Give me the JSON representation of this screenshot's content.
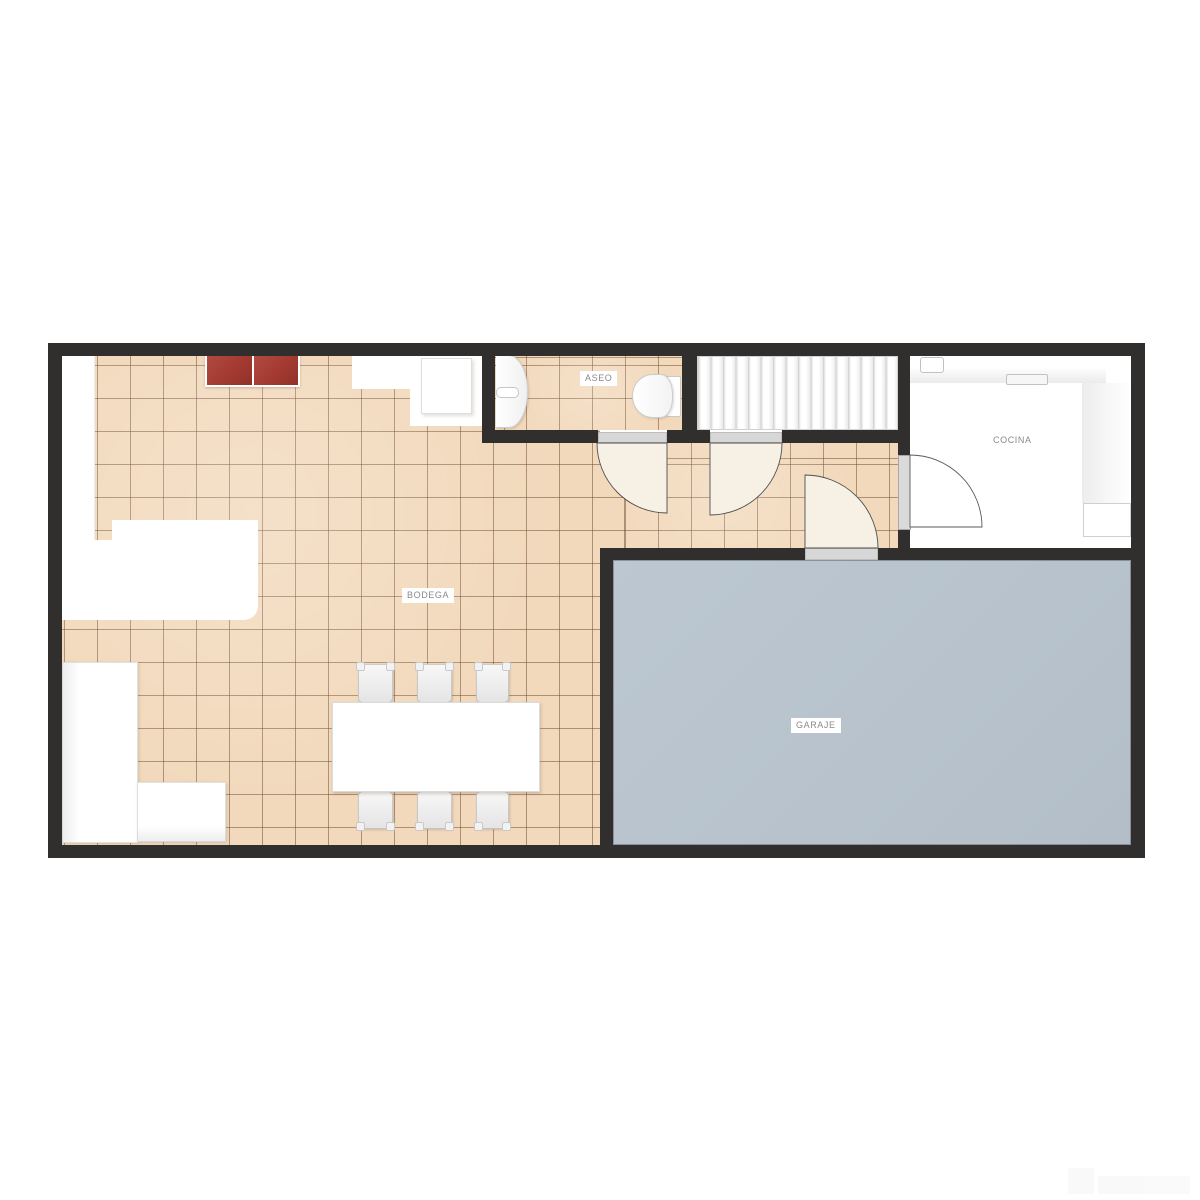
{
  "plan": {
    "type": "floor-plan",
    "labels": {
      "bodega": "BODEGA",
      "aseo": "ASEO",
      "cocina": "COCINA",
      "garaje": "GARAJE"
    },
    "rooms": [
      {
        "id": "bodega",
        "label": "BODEGA",
        "floor": "terracotta-tile"
      },
      {
        "id": "aseo",
        "label": "ASEO",
        "floor": "terracotta-tile"
      },
      {
        "id": "cocina",
        "label": "COCINA",
        "floor": "white"
      },
      {
        "id": "garaje",
        "label": "GARAJE",
        "floor": "blue-gray-concrete"
      }
    ],
    "furniture": [
      "red-cabinet",
      "wall-counter",
      "corner-sofa",
      "dining-table",
      "dining-chairs-x6",
      "washbasin",
      "toilet",
      "stairs-16-treads",
      "kitchen-counter-L",
      "kitchen-sink",
      "cooktop",
      "fridge",
      "swing-doors-x4",
      "garage-door"
    ],
    "counts": {
      "chairs": 6,
      "stair_treads": 16,
      "swing_doors": 4
    },
    "colors": {
      "wall": "#302f2e",
      "tile": "#f2d9bc",
      "tile_grout": "#68482a",
      "garage_floor": "#b7c2cc",
      "accent_red": "#a33a31",
      "door_fill": "#f7f0e5",
      "lintel": "#d7d7d7",
      "label_text": "#8a8a8a"
    }
  }
}
